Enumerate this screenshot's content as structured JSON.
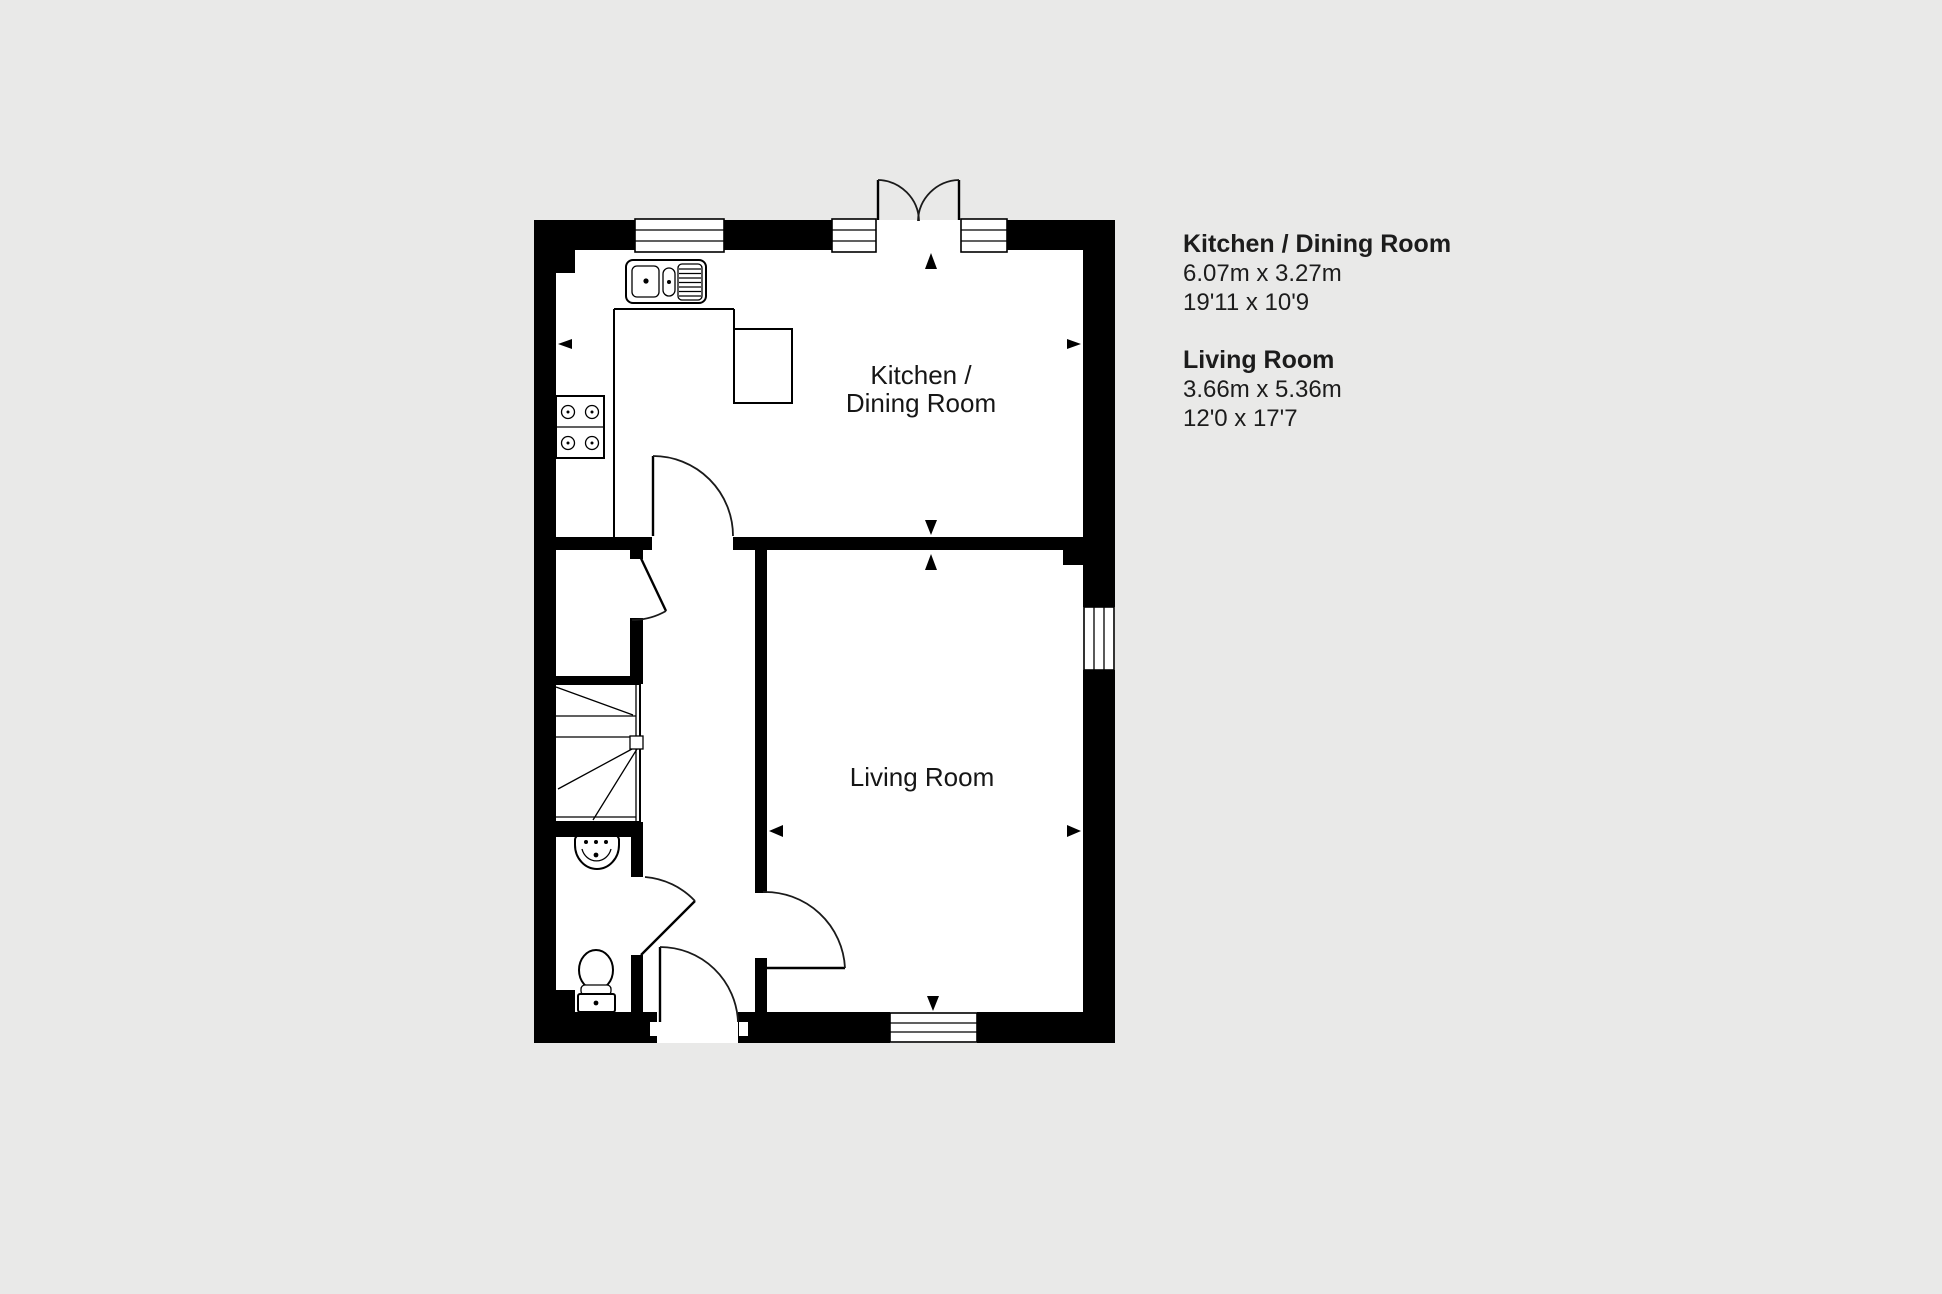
{
  "page": {
    "background": "#e9e9e8"
  },
  "plan": {
    "kitchen_label_line1": "Kitchen /",
    "kitchen_label_line2": "Dining Room",
    "living_label": "Living Room"
  },
  "legend": {
    "kitchen": {
      "name": "Kitchen / Dining Room",
      "metric": "6.07m x 3.27m",
      "imperial": "19'11 x 10'9"
    },
    "living": {
      "name": "Living Room",
      "metric": "3.66m x 5.36m",
      "imperial": "12'0 x 17'7"
    }
  }
}
